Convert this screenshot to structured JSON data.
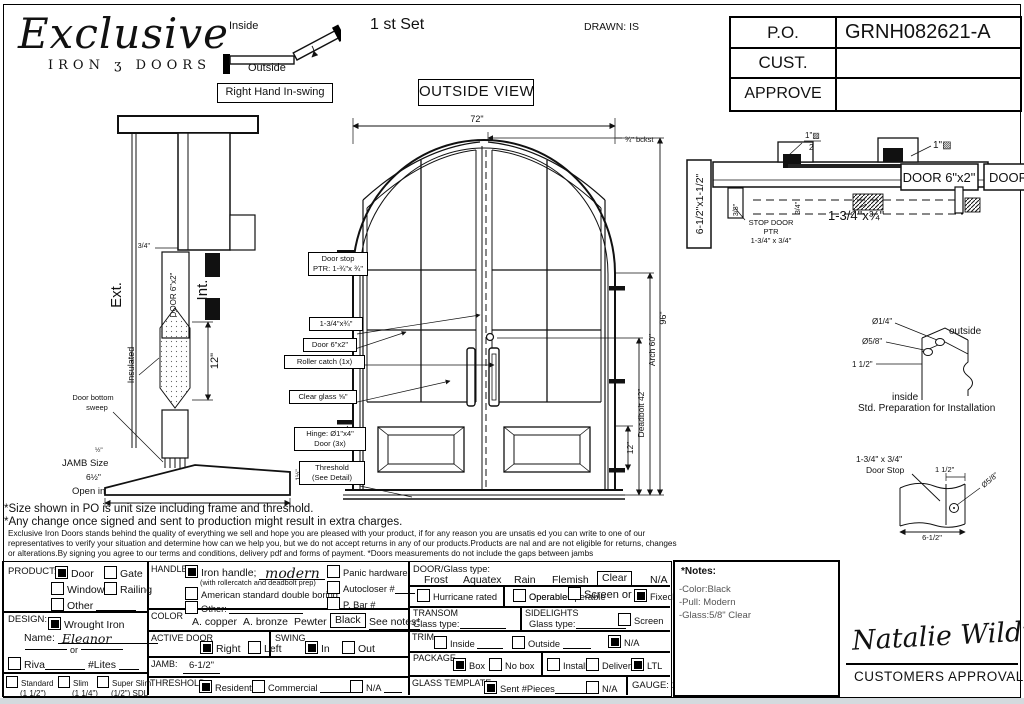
{
  "logo": {
    "name": "Exclusive",
    "sub_left": "IRON",
    "sub_swirl": "ʒ",
    "sub_right": "DOORS"
  },
  "swing": {
    "inside": "Inside",
    "outside": "Outside",
    "label": "Right Hand In-swing"
  },
  "titles": {
    "set": "1 st Set",
    "drawn": "DRAWN: IS",
    "view": "OUTSIDE VIEW"
  },
  "po_table": {
    "rows": [
      {
        "label": "P.O.",
        "value": "GRNH082621-A"
      },
      {
        "label": "CUST.",
        "value": ""
      },
      {
        "label": "APPROVE",
        "value": ""
      }
    ]
  },
  "jamb_section": {
    "ext": "Ext.",
    "int": "Int.",
    "door": "DOOR 6\"x2\"",
    "insulated": "Insulated",
    "dim_34": "3/4\"",
    "dim_12": "12\"",
    "sweep1": "Door bottom",
    "sweep2": "sweep",
    "dim_half_left": "½\"",
    "dim_half_right": "½\"",
    "dim_1half": "1½\"",
    "jamb_size": "JAMB Size",
    "jamb_dim": "6½\"",
    "open_in": "Open in"
  },
  "outside_view": {
    "dim_width": "72\"",
    "dim_backset": "¾\" bckst",
    "dim_height": "96\"",
    "dim_arch": "Arch 60\"",
    "dim_deadbolt": "Deadbolt 42\"",
    "dim_hinge": "12\"",
    "callout_doorstop_1": "Door stop",
    "callout_doorstop_2": "PTR: 1-¾\"x ¾\"",
    "callout_ptr": "1-3/4\"x¾\"",
    "callout_door": "Door 6\"x2\"",
    "callout_roller": "Roller catch  (1x)",
    "callout_glass": "Clear glass ⅝\"",
    "callout_hinge_1": "Hinge: Ø1\"x4\"",
    "callout_hinge_2": "Door (3x)",
    "callout_threshold_1": "Threshold",
    "callout_threshold_2": "(See Detail)"
  },
  "head_section": {
    "jamb_label": "6-1/2\"x1-1/2\"",
    "half_num": "1\"▨",
    "half_den": "2",
    "one": "1\"▨",
    "dim_38": "3/8\"",
    "dim_34": "3/4\"",
    "stop_1": "STOP DOOR",
    "stop_2": "PTR",
    "stop_3": "1-3/4\" x 3/4\"",
    "door_label": "DOOR 6\"x2\"",
    "door_label_2": "DOOR 6\"x2\"",
    "ptr_dim": "1-3/4\"x¾\""
  },
  "install_detail": {
    "d14": "Ø1/4\"",
    "d58": "Ø5/8\"",
    "outside": "outside",
    "dim112": "1 1/2\"",
    "inside": "inside",
    "caption": "Std. Preparation for Installation"
  },
  "stop_detail": {
    "size": "1-3/4\" x 3/4\"",
    "name": "Door Stop",
    "dim112": "1 1/2\"",
    "d58": "Ø5/8\"",
    "width": "6-1/2\""
  },
  "notes": {
    "line1": "*Size shown in PO is unit size including frame and threshold.",
    "line2": "*Any change once signed and sent to production might result in extra charges.",
    "small1": "Exclusive Iron Doors stands behind the quality of everything we sell and hope you are pleased with your product, if for any reason you are unsatis   ed you can write to one of our",
    "small2": "representatives to verify your situation and determine how can we help you, but we do not accept returns in any of our products.Products are   nal and are not eligible for returns, changes",
    "small3": "or alterations.By signing you agree to our terms and conditions, delivery pdf and forms of payment. *Doors measurements do not include the gaps between jambs"
  },
  "form": {
    "product": {
      "label": "PRODUCT:",
      "door": "Door",
      "gate": "Gate",
      "window": "Window",
      "railing": "Railing",
      "other": "Other"
    },
    "design": {
      "label": "DESIGN:",
      "wrought": "Wrought Iron",
      "name_label": "Name:",
      "name_value": "Eleanor",
      "or": "or",
      "riva": "Riva",
      "lites": "#Lites",
      "standard": "Standard",
      "standard_sub": "(1 1/2\")",
      "slim": "Slim",
      "slim_sub": "(1 1/4\")",
      "superslim": "Super Slim",
      "superslim_sub": "(1/2\") SDL"
    },
    "handle": {
      "label": "HANDLE",
      "iron": "Iron handle;",
      "iron_value": "modern",
      "iron_sub": "(with rollercatch and deadbolt prep)",
      "american": "American standard double boring",
      "other": "Other:",
      "panic": "Panic hardware",
      "autocloser": "Autocloser #",
      "pbar": "P. Bar #"
    },
    "color": {
      "label": "COLOR",
      "options": [
        "A. copper",
        "A. bronze",
        "Pewter",
        "Black"
      ],
      "see_notes": "See notes*"
    },
    "active": {
      "label": "ACTIVE DOOR",
      "right": "Right",
      "left": "Left"
    },
    "swing": {
      "label": "SWING",
      "in": "In",
      "out": "Out"
    },
    "jamb": {
      "label": "JAMB:",
      "value": "6-1/2\""
    },
    "threshold": {
      "label": "THRESHOLD",
      "residential": "Residential",
      "commercial": "Commercial",
      "na": "N/A"
    },
    "glass": {
      "label": "DOOR/Glass type:",
      "options": [
        "Frost",
        "Aquatex",
        "Rain",
        "Flemish",
        "Clear",
        "N/A"
      ],
      "hurricane": "Hurricane rated",
      "operable": "Operable",
      "screen_or": "Screen or",
      "fixed": "Fixed"
    },
    "transom": {
      "label": "TRANSOM",
      "glass_type": "Glass type:"
    },
    "sidelights": {
      "label": "SIDELIGHTS",
      "glass_type": "Glass type:",
      "screen": "Screen"
    },
    "trim": {
      "label": "TRIM",
      "inside": "Inside",
      "outside": "Outside",
      "na": "N/A"
    },
    "package": {
      "label": "PACKAGE",
      "box": "Box",
      "nobox": "No box",
      "install": "Install",
      "delivery": "Delivery",
      "ltl": "LTL"
    },
    "template": {
      "label": "GLASS TEMPLATE",
      "sent": "Sent #Pieces",
      "na": "N/A",
      "gauge": "GAUGE: 14"
    }
  },
  "notes_box": {
    "title": "*Notes:",
    "line1": "-Color:Black",
    "line2": "-Pull: Modern",
    "line3": "-Glass:5/8\" Clear"
  },
  "approval": {
    "signature": "Natalie Wildt",
    "label": "CUSTOMERS APPROVAL"
  }
}
